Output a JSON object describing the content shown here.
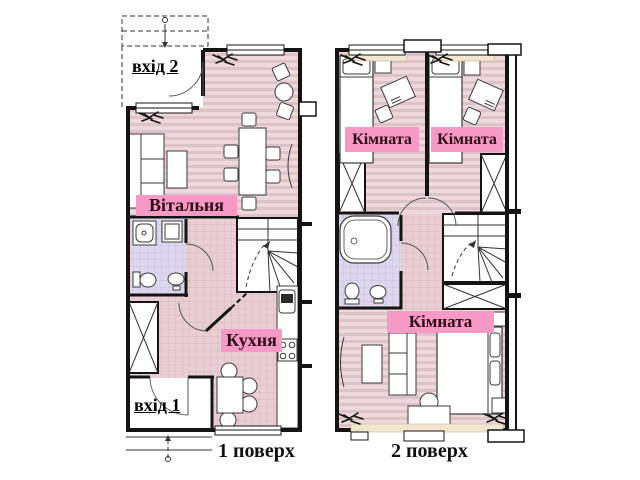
{
  "floor1": {
    "entrance2_label": "вхід 2",
    "living_room_label": "Вітальня",
    "kitchen_label": "Кухня",
    "entrance1_label": "вхід 1",
    "caption": "1 поверх"
  },
  "floor2": {
    "room1_label": "Кімната",
    "room2_label": "Кімната",
    "room3_label": "Кімната",
    "caption": "2 поверх"
  },
  "colors": {
    "label_band": "#f799c5",
    "label_text": "#2e0d18",
    "floor_stripe_base": "#edd8db",
    "floor_stripe_dark": "#ddc2c8",
    "tile_base": "#e9cfd4",
    "tile_line": "#d8b5bd",
    "bathroom_tile": "#ded7ee",
    "bathroom_tile_line": "#c8bcdf",
    "wall": "#141414",
    "window_sill": "#f3e6cf"
  }
}
